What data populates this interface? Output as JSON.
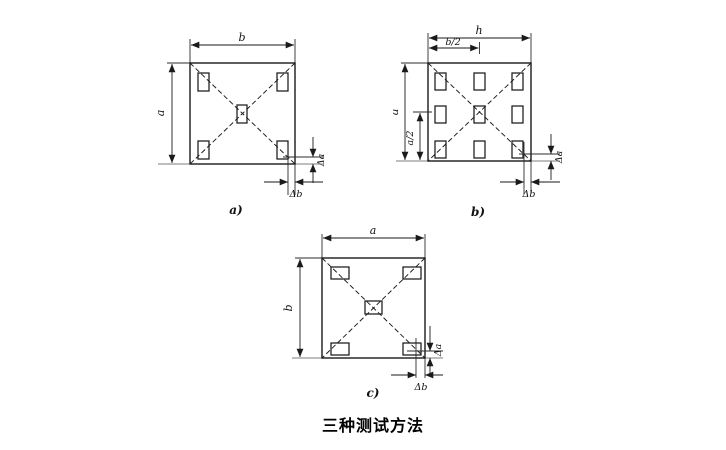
{
  "figure": {
    "caption": "三种测试方法"
  },
  "panels": {
    "a": {
      "label": "a)",
      "dim_top": "b",
      "dim_left": "a",
      "delta_a": "Δa",
      "delta_b": "Δb",
      "pad_count": 5
    },
    "b": {
      "label": "b)",
      "dim_top": "h",
      "dim_top_half": "b/2",
      "dim_left": "a",
      "dim_left_half": "a/2",
      "delta_a": "Δa",
      "delta_b": "Δb",
      "pad_count": 9
    },
    "c": {
      "label": "c)",
      "dim_top": "a",
      "dim_left": "b",
      "delta_a": "Δa",
      "delta_b": "Δb",
      "pad_count": 5
    }
  },
  "colors": {
    "line": "#1a1a1a",
    "extension_line": "#7d7d7d",
    "background": "#ffffff",
    "text": "#111111"
  }
}
